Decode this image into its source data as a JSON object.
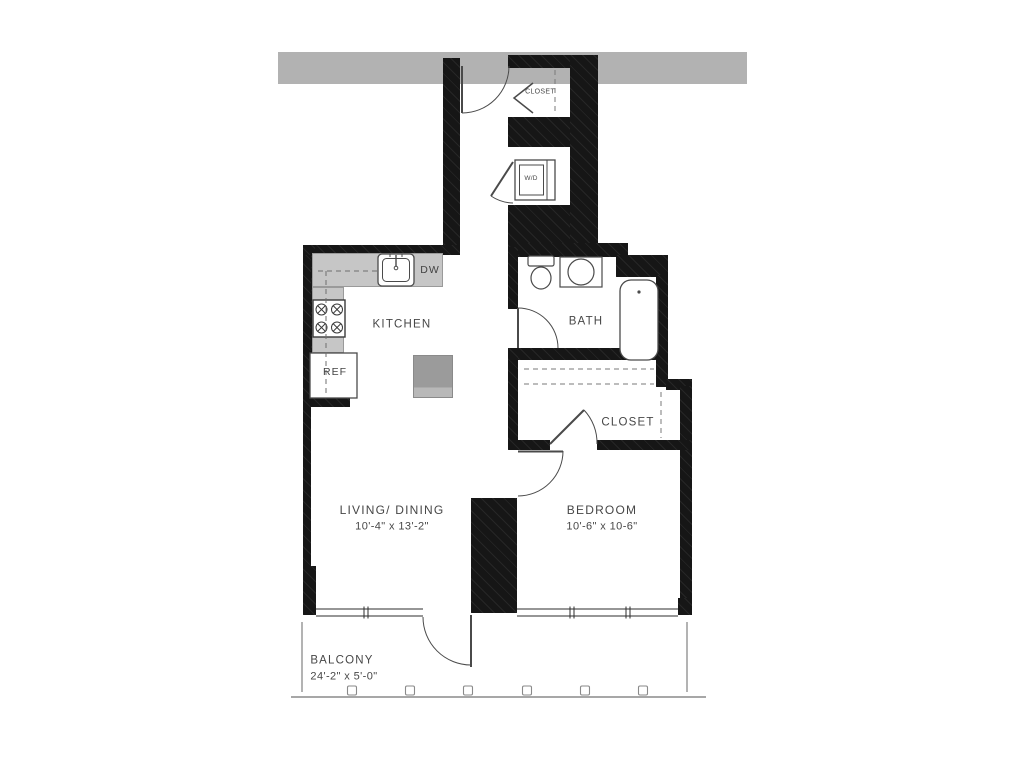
{
  "rooms": {
    "kitchen": {
      "label": "KITCHEN"
    },
    "living_dining": {
      "label": "LIVING/ DINING",
      "dimensions": "10'-4\" x 13'-2\""
    },
    "bedroom": {
      "label": "BEDROOM",
      "dimensions": "10'-6\" x 10-6\""
    },
    "bath": {
      "label": "BATH"
    },
    "bedroom_closet": {
      "label": "CLOSET"
    },
    "entry_closet": {
      "label": "CLOSET"
    },
    "balcony": {
      "label": "BALCONY",
      "dimensions": "24'-2\" x 5'-0\""
    }
  },
  "appliances": {
    "dishwasher": "DW",
    "refrigerator": "REF",
    "washer_dryer": "W/D"
  },
  "colors": {
    "wall": "#161616",
    "building_band": "#b2b2b2",
    "counter": "#c6c6c6",
    "island": "#9b9b9b",
    "linework": "#4a4a4a",
    "text": "#474747"
  }
}
